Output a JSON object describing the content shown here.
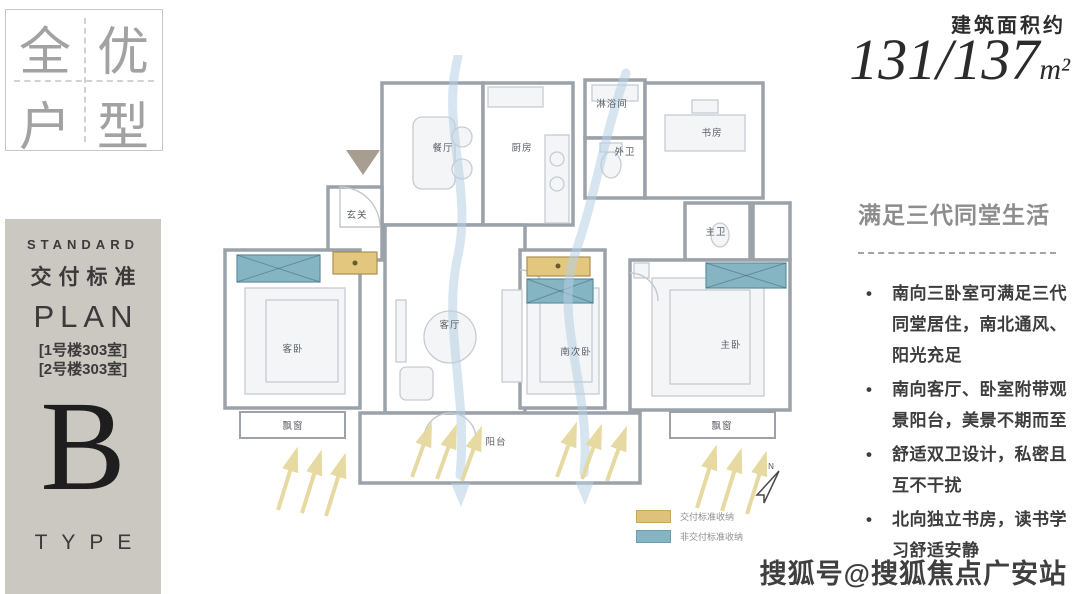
{
  "logo_box": {
    "char_1": "全",
    "char_2": "优",
    "char_3": "户",
    "char_4": "型"
  },
  "standard_panel": {
    "title_en": "STANDARD",
    "title_cn": "交付标准",
    "plan_label": "PLAN",
    "room_line_1": "[1号楼303室]",
    "room_line_2": "[2号楼303室]",
    "type_letter": "B",
    "type_label": "TYPE"
  },
  "area": {
    "label": "建筑面积约",
    "value": "131/137",
    "unit": "m²"
  },
  "floor_plan": {
    "rooms": {
      "dining": "餐厅",
      "kitchen": "厨房",
      "shower": "淋浴间",
      "guest_wc": "外卫",
      "study": "书房",
      "foyer": "玄关",
      "master_bath": "主卫",
      "guest_bedroom": "客卧",
      "living": "客厅",
      "south_bedroom": "南次卧",
      "master_bedroom": "主卧",
      "bay_window_left": "飘窗",
      "bay_window_right": "飘窗",
      "balcony": "阳台"
    },
    "compass_label": "N",
    "legend": {
      "item_1": "交付标准收纳",
      "item_2": "非交付标准收纳"
    }
  },
  "selling_points": {
    "heading": "满足三代同堂生活",
    "bullet_1": "南向三卧室可满足三代同堂居住，南北通风、阳光充足",
    "bullet_2": "南向客厅、卧室附带观景阳台，美景不期而至",
    "bullet_3": "舒适双卫设计，私密且互不干扰",
    "bullet_4": "北向独立书房，读书学习舒适安静"
  },
  "watermark": "搜狐号@搜狐焦点广安站",
  "colors": {
    "standard_storage": "#dfc17c",
    "non_standard_storage": "#85b4c2",
    "wall": "#9ba2aa",
    "panel_bg": "#cbc7c1",
    "wind_flow": "#b5cfe4",
    "sunlight": "#e5d89d"
  }
}
